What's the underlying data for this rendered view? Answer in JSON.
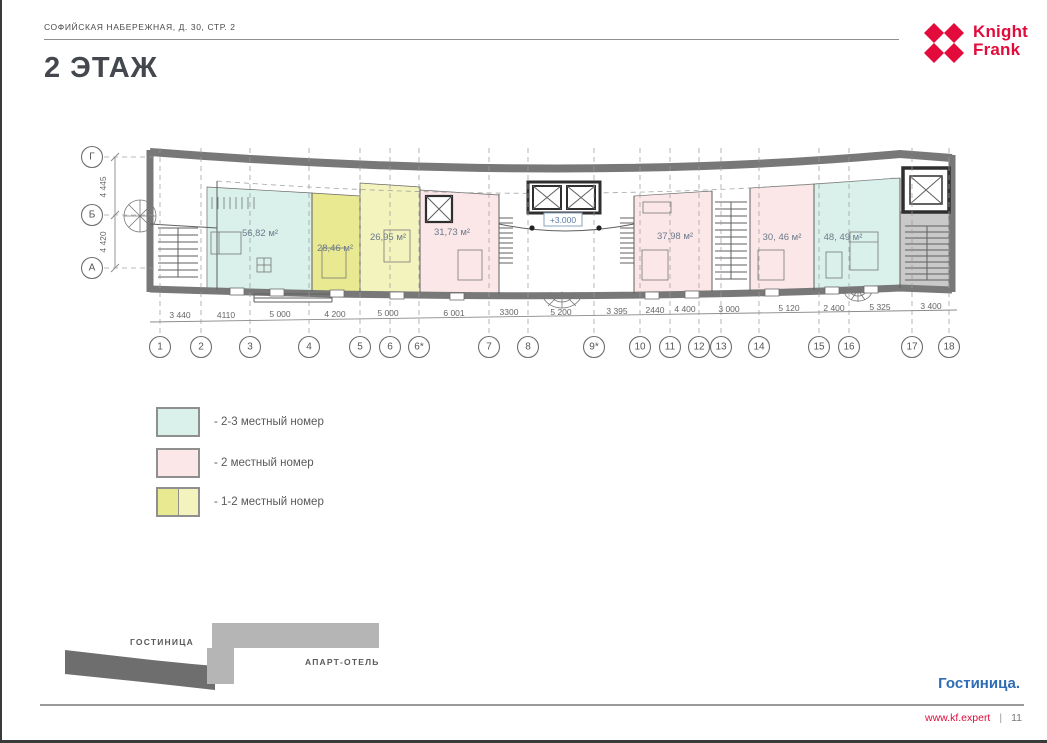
{
  "header": {
    "address": "СОФИЙСКАЯ НАБЕРЕЖНАЯ, Д. 30, СТР. 2"
  },
  "logo": {
    "line1": "Knight",
    "line2": "Frank",
    "color": "#e30b3c"
  },
  "title": "2 ЭТАЖ",
  "plan": {
    "level_mark": "+3.000",
    "rooms": [
      {
        "area": "56,82 м²",
        "x": 258,
        "y": 236
      },
      {
        "area": "28,46 м²",
        "x": 333,
        "y": 251
      },
      {
        "area": "26,95 м²",
        "x": 386,
        "y": 240
      },
      {
        "area": "31,73 м²",
        "x": 450,
        "y": 235
      },
      {
        "area": "37,98 м²",
        "x": 673,
        "y": 239
      },
      {
        "area": "30, 46 м²",
        "x": 780,
        "y": 240
      },
      {
        "area": "48, 49 м²",
        "x": 841,
        "y": 240
      }
    ],
    "row_axes": [
      {
        "label": "1",
        "x": 158
      },
      {
        "label": "2",
        "x": 199
      },
      {
        "label": "3",
        "x": 248
      },
      {
        "label": "4",
        "x": 307
      },
      {
        "label": "5",
        "x": 358
      },
      {
        "label": "6",
        "x": 388
      },
      {
        "label": "6*",
        "x": 417
      },
      {
        "label": "7",
        "x": 487
      },
      {
        "label": "8",
        "x": 526
      },
      {
        "label": "9*",
        "x": 592
      },
      {
        "label": "10",
        "x": 638
      },
      {
        "label": "11",
        "x": 668
      },
      {
        "label": "12",
        "x": 697
      },
      {
        "label": "13",
        "x": 719
      },
      {
        "label": "14",
        "x": 757
      },
      {
        "label": "15",
        "x": 817
      },
      {
        "label": "16",
        "x": 847
      },
      {
        "label": "17",
        "x": 910
      },
      {
        "label": "18",
        "x": 947
      }
    ],
    "row_dims": [
      {
        "value": "3 440",
        "x": 178,
        "y": 318
      },
      {
        "value": "4110",
        "x": 224,
        "y": 318
      },
      {
        "value": "5 000",
        "x": 278,
        "y": 317
      },
      {
        "value": "4 200",
        "x": 333,
        "y": 317
      },
      {
        "value": "5 000",
        "x": 386,
        "y": 316
      },
      {
        "value": "6 001",
        "x": 452,
        "y": 316
      },
      {
        "value": "3300",
        "x": 507,
        "y": 315
      },
      {
        "value": "5 200",
        "x": 559,
        "y": 315
      },
      {
        "value": "3 395",
        "x": 615,
        "y": 314
      },
      {
        "value": "2440",
        "x": 653,
        "y": 313
      },
      {
        "value": "4 400",
        "x": 683,
        "y": 312
      },
      {
        "value": "3 000",
        "x": 727,
        "y": 312
      },
      {
        "value": "5 120",
        "x": 787,
        "y": 311
      },
      {
        "value": "2 400",
        "x": 832,
        "y": 311
      },
      {
        "value": "5 325",
        "x": 878,
        "y": 310
      },
      {
        "value": "3 400",
        "x": 929,
        "y": 309
      }
    ],
    "col_axes": [
      {
        "label": "Г",
        "y": 157
      },
      {
        "label": "Б",
        "y": 215
      },
      {
        "label": "А",
        "y": 268
      }
    ],
    "col_dims": [
      {
        "value": "4 445"
      },
      {
        "value": "4 420"
      }
    ]
  },
  "legend": {
    "items": [
      {
        "label": "- 2-3 местный номер",
        "color": "#d9f1ea"
      },
      {
        "label": "- 2 местный номер",
        "color": "#fbe7e7"
      },
      {
        "label": "- 1-2 местный номер",
        "color": "#e9e992",
        "color2": "#f3f3be"
      }
    ]
  },
  "minimap": {
    "hotel_label": "ГОСТИНИЦА",
    "apart_label": "АПАРТ-ОТЕЛЬ"
  },
  "caption": "Гостиница.",
  "footer": {
    "site": "www.kf.expert",
    "separator": "|",
    "page_number": "11"
  }
}
